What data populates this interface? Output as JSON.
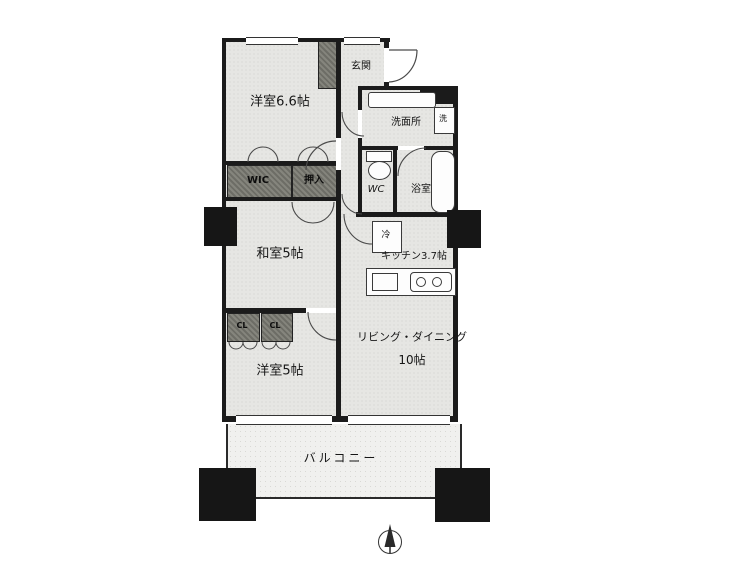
{
  "rooms": {
    "west66": {
      "label": "洋室6.6帖"
    },
    "genkan": {
      "label": "玄関"
    },
    "washroom": {
      "label": "洗面所"
    },
    "washer": {
      "label": "洗"
    },
    "wic": {
      "label": "WIC"
    },
    "oshiire": {
      "label": "押入"
    },
    "wc": {
      "label": "WC"
    },
    "bath": {
      "label": "浴室"
    },
    "washitsu": {
      "label": "和室5帖"
    },
    "fridge": {
      "label": "冷"
    },
    "kitchen": {
      "label": "キッチン3.7帖"
    },
    "living": {
      "label": "リビング・ダイニング",
      "size": "10帖"
    },
    "closet": {
      "label": "CL"
    },
    "west5": {
      "label": "洋室5帖"
    },
    "balcony": {
      "label": "バルコニー"
    }
  },
  "icons": {
    "compass": "north-arrow-icon"
  },
  "colors": {
    "wall": "#1b1b1b",
    "room_fill": "#e6e6e3",
    "storage_fill": "#77776f",
    "balcony_fill": "#f0f0ee",
    "text": "#161616"
  }
}
